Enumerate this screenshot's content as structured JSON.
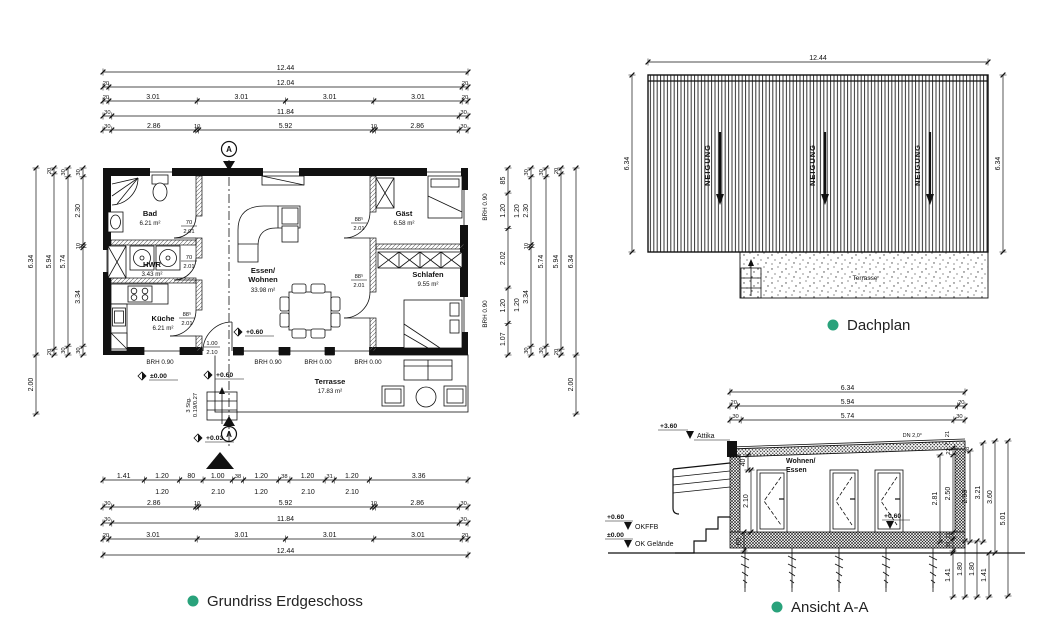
{
  "colors": {
    "accent": "#29a27b",
    "ink": "#111111"
  },
  "captions": {
    "plan": "Grundriss Erdgeschoss",
    "roof": "Dachplan",
    "section": "Ansicht A-A"
  },
  "plan": {
    "dims_top": {
      "row1": "12.44",
      "row2": [
        "20",
        "12.04",
        "20"
      ],
      "row3": [
        "20",
        "3.01",
        "3.01",
        "3.01",
        "3.01",
        "20"
      ],
      "row4": [
        "30",
        "11.84",
        "30"
      ],
      "row5": [
        "30",
        "2.86",
        "10",
        "5.92",
        "10",
        "2.86",
        "30"
      ]
    },
    "dims_bottom": {
      "row1": [
        "1.41",
        "1.20",
        "80",
        "1.00",
        "38",
        "1.20",
        "38",
        "1.20",
        "31",
        "1.20",
        "3.36"
      ],
      "row1_sub": [
        "1.20",
        "2.10",
        "1.20",
        "2.10",
        "2.10"
      ],
      "row2": [
        "30",
        "2.86",
        "10",
        "5.92",
        "10",
        "2.86",
        "30"
      ],
      "row3": [
        "30",
        "11.84",
        "30"
      ],
      "row4": [
        "20",
        "3.01",
        "3.01",
        "3.01",
        "3.01",
        "20"
      ],
      "row5": "12.44"
    },
    "dims_left": {
      "col1": [
        "6.34",
        "2.00"
      ],
      "col2": [
        "20",
        "5.94",
        "20"
      ],
      "col3": [
        "30",
        "5.74",
        "30"
      ],
      "col4": [
        "30",
        "2.30",
        "10",
        "3.34",
        "30"
      ]
    },
    "dims_right": {
      "col1": [
        "85",
        "1.20",
        "2.02",
        "1.20",
        "1.07"
      ],
      "col1_sub": [
        "1.20",
        "1.20"
      ],
      "col2": [
        "30",
        "2.30",
        "10",
        "3.34",
        "30"
      ],
      "col3": [
        "30",
        "5.74",
        "30"
      ],
      "col4": [
        "20",
        "5.94",
        "20"
      ],
      "col5": [
        "6.34",
        "2.00"
      ]
    },
    "rooms": {
      "bad": {
        "name": "Bad",
        "area": "6.21 m²"
      },
      "hwr": {
        "name": "HWR",
        "area": "3.43 m²"
      },
      "kueche": {
        "name": "Küche",
        "area": "6.21 m²"
      },
      "wohnen": {
        "name1": "Essen/",
        "name2": "Wohnen",
        "area": "33.98 m²"
      },
      "gast": {
        "name": "Gäst",
        "area": "6.58 m²"
      },
      "schlafen": {
        "name": "Schlafen",
        "area": "9.55 m²"
      },
      "terrasse": {
        "name": "Terrasse",
        "area": "17.83 m²"
      }
    },
    "doors": {
      "bad": {
        "w": "70",
        "h": "2.01"
      },
      "hwr": {
        "w": "70",
        "h": "2.01"
      },
      "kueche": {
        "w": "88⁵",
        "h": "2.01"
      },
      "gast": {
        "w": "88⁵",
        "h": "2.01"
      },
      "schlafen": {
        "w": "88⁵",
        "h": "2.01"
      },
      "entry": {
        "w": "1.00",
        "h": "2.10"
      }
    },
    "brh": {
      "kueche": "BRH 0.90",
      "t1": "BRH 0.90",
      "t2": "BRH 0.00",
      "t3": "BRH 0.00",
      "right_top": "BRH 0.90",
      "right_bottom": "BRH 0.90"
    },
    "levels": {
      "zero": "±0.00",
      "l060_out": "+0.60",
      "l060_in": "+0.60",
      "l003": "+0.03"
    },
    "stairs1": "3 Stg.",
    "stairs2": "0.19/0.27",
    "section_letter": "A"
  },
  "roof": {
    "dim_top": "12.44",
    "dim_left": "6.34",
    "dim_right": "6.34",
    "slope": "NEIGUNG",
    "terrace": "Terrasse"
  },
  "section": {
    "dims_top": {
      "row1": "6.34",
      "row2": [
        "20",
        "5.94",
        "20"
      ],
      "row3": [
        "30",
        "5.74",
        "30"
      ]
    },
    "levels": {
      "attika_val": "+3.60",
      "attika": "Attika",
      "okffb_val": "+0.60",
      "okffb": "OKFFB",
      "ground_val": "±0.00",
      "ground": "OK Gelände",
      "inner": "+0.60"
    },
    "room1": "Wohnen/",
    "room2": "Essen",
    "door_h": "2.10",
    "d40": "40",
    "d60": "60",
    "roof_slope": "DN 2,0°",
    "dims_right": {
      "c281": "2.81",
      "chain": [
        "22",
        "2.50",
        "21",
        "39"
      ],
      "c293": "2.93",
      "c321": "3.21",
      "c360": "3.60",
      "c501": "5.01",
      "below": [
        "1.41",
        "1.80",
        "1.80",
        "1.41"
      ],
      "small": [
        "21",
        "7",
        "28"
      ]
    }
  }
}
